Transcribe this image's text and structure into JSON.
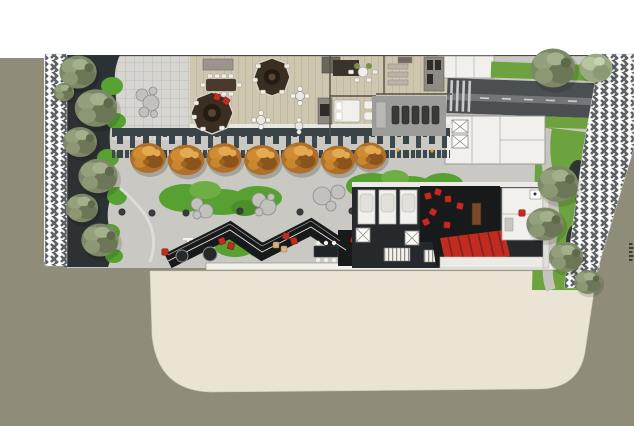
{
  "scene": {
    "kind": "architectural-landscape-site-plan",
    "view": "top-down-rendered-plan",
    "visible_text": []
  },
  "colors": {
    "background": "#ffffff",
    "road": "#8f8c7a",
    "sand": "#e9e4d3",
    "hatch_ink": "#5d6163",
    "plaza": "#c9c8c3",
    "paver_grid": "#d6d5d0",
    "deck": "#cfc6b0",
    "planting_dark": "#2c3134",
    "skyline_band": "#3e494d",
    "tree_olive": "#7c8866",
    "tree_light": "#9aa884",
    "shrub_green": "#57a032",
    "lawn": "#6da33e",
    "autumn_tree": "#c8862f",
    "driveway": "#4c4f51",
    "roof_dark": "#17191b",
    "roof_white": "#f1f0ec",
    "red_accent": "#c22b20",
    "gym_floor": "#9c9c9a",
    "boulder": "#c2c1bd",
    "curb": "#f2f1ea"
  },
  "inventory": {
    "left_edge_trees": 7,
    "autumn_trees_row": 7,
    "lawn_trees_right": 4,
    "top_right_trees": 2,
    "octagonal_fire_lounges": 2,
    "long_dining_chairs": 10,
    "treadmills": 5,
    "washroom_stalls": 3,
    "elevator_cores_with_x": 4,
    "red_chairs_total": 15,
    "bollards": 6,
    "boulder_clusters": 4,
    "zigzag_canopy_peaks": 2,
    "hatched_boundary_strips": 2
  }
}
